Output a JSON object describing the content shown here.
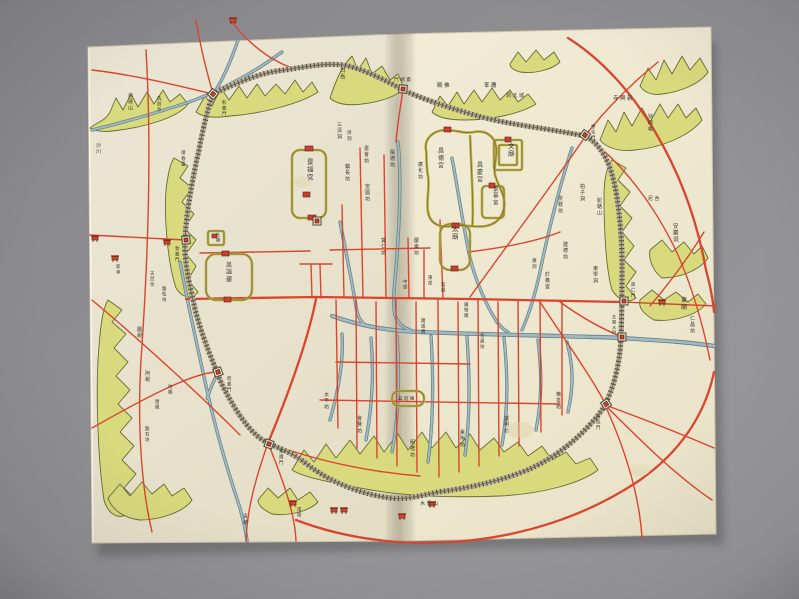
{
  "photo": {
    "description": "photograph of an opened book containing a hand-drawn historical map of Hanyang (Seoul)",
    "palette": {
      "backdrop_gray": "#8f8f92",
      "paper_cream": "#f1ecd7",
      "road_red": "#d8462f",
      "stream_blue": "#7f9ba6",
      "mountain_green": "#d9da7d",
      "wall_ink": "#544f3e",
      "palace_wall_olive": "#b9ad4a",
      "text_ink": "#37362c"
    }
  },
  "map": {
    "labels": [
      {
        "text": "景福宮",
        "x": 307,
        "y": 164,
        "dir": "v",
        "size": 6.5
      },
      {
        "text": "昌德宮",
        "x": 438,
        "y": 153,
        "dir": "v",
        "size": 6
      },
      {
        "text": "昌慶宮",
        "x": 477,
        "y": 167,
        "dir": "v",
        "size": 6
      },
      {
        "text": "景慕宮",
        "x": 493,
        "y": 191,
        "dir": "v",
        "size": 5.5
      },
      {
        "text": "文廟",
        "x": 508,
        "y": 148,
        "dir": "v",
        "size": 6.5
      },
      {
        "text": "太廟",
        "x": 452,
        "y": 231,
        "dir": "v",
        "size": 6.5
      },
      {
        "text": "慶熙宮",
        "x": 228,
        "y": 266,
        "dir": "vr",
        "size": 6
      },
      {
        "text": "社稷",
        "x": 216,
        "y": 236,
        "dir": "v",
        "size": 4.2
      },
      {
        "text": "三清洞",
        "x": 337,
        "y": 126,
        "dir": "v",
        "size": 5
      },
      {
        "text": "白岳",
        "x": 340,
        "y": 72,
        "dir": "v",
        "size": 5.5
      },
      {
        "text": "濟洞",
        "x": 347,
        "y": 134,
        "dir": "v",
        "size": 4.6
      },
      {
        "text": "嘉會坊",
        "x": 364,
        "y": 150,
        "dir": "v",
        "size": 5
      },
      {
        "text": "陽德坊",
        "x": 390,
        "y": 154,
        "dir": "v",
        "size": 5
      },
      {
        "text": "鎮長坊",
        "x": 345,
        "y": 168,
        "dir": "v",
        "size": 5
      },
      {
        "text": "安國坊",
        "x": 365,
        "y": 188,
        "dir": "v",
        "size": 5
      },
      {
        "text": "廣化坊",
        "x": 418,
        "y": 166,
        "dir": "v",
        "size": 5
      },
      {
        "text": "寬仁坊",
        "x": 381,
        "y": 242,
        "dir": "v",
        "size": 5
      },
      {
        "text": "慶幸坊",
        "x": 414,
        "y": 242,
        "dir": "v",
        "size": 5
      },
      {
        "text": "崇敎坊",
        "x": 558,
        "y": 200,
        "dir": "v",
        "size": 5
      },
      {
        "text": "柏子洞",
        "x": 580,
        "y": 188,
        "dir": "v",
        "size": 5
      },
      {
        "text": "建德坊",
        "x": 563,
        "y": 246,
        "dir": "v",
        "size": 5
      },
      {
        "text": "東學洞",
        "x": 593,
        "y": 270,
        "dir": "v",
        "size": 5
      },
      {
        "text": "於義宮",
        "x": 545,
        "y": 276,
        "dir": "v",
        "size": 5
      },
      {
        "text": "蓮洞",
        "x": 532,
        "y": 262,
        "dir": "v",
        "size": 4.6
      },
      {
        "text": "洞北城",
        "x": 506,
        "y": 97,
        "dir": "h",
        "size": 5
      },
      {
        "text": "峯鷹",
        "x": 484,
        "y": 87,
        "dir": "h",
        "size": 5.5
      },
      {
        "text": "殿佛",
        "x": 437,
        "y": 87,
        "dir": "h",
        "size": 5.5
      },
      {
        "text": "門靖肅",
        "x": 394,
        "y": 81,
        "dir": "h",
        "size": 4.6
      },
      {
        "text": "彰義門",
        "x": 222,
        "y": 104,
        "dir": "v",
        "size": 4.4
      },
      {
        "text": "惠化門",
        "x": 591,
        "y": 128,
        "dir": "v",
        "size": 4.4
      },
      {
        "text": "興仁門",
        "x": 631,
        "y": 286,
        "dir": "v",
        "size": 4.4
      },
      {
        "text": "五間水門",
        "x": 612,
        "y": 318,
        "dir": "v",
        "size": 4.2
      },
      {
        "text": "光熙門",
        "x": 596,
        "y": 418,
        "dir": "v",
        "size": 4.4
      },
      {
        "text": "崇禮門",
        "x": 279,
        "y": 453,
        "dir": "v",
        "size": 4.4
      },
      {
        "text": "昭義門",
        "x": 227,
        "y": 380,
        "dir": "v",
        "size": 4.4
      },
      {
        "text": "敦義門",
        "x": 175,
        "y": 250,
        "dir": "v",
        "size": 4.4
      },
      {
        "text": "東廟",
        "x": 681,
        "y": 302,
        "dir": "v",
        "size": 6
      },
      {
        "text": "仁昌坊",
        "x": 690,
        "y": 320,
        "dir": "v",
        "size": 5
      },
      {
        "text": "安巖洞",
        "x": 673,
        "y": 228,
        "dir": "v",
        "size": 5.5
      },
      {
        "text": "寺興新",
        "x": 613,
        "y": 100,
        "dir": "h",
        "size": 5.5
      },
      {
        "text": "狄踰峴",
        "x": 648,
        "y": 118,
        "dir": "v",
        "size": 5
      },
      {
        "text": "駝駱山",
        "x": 597,
        "y": 202,
        "dir": "v",
        "size": 5
      },
      {
        "text": "尼含",
        "x": 648,
        "y": 200,
        "dir": "h",
        "size": 5
      },
      {
        "text": "蕩春臺",
        "x": 181,
        "y": 154,
        "dir": "v",
        "size": 4.6
      },
      {
        "text": "洗劍亭",
        "x": 157,
        "y": 100,
        "dir": "v",
        "size": 4.4
      },
      {
        "text": "白蓮山",
        "x": 128,
        "y": 97,
        "dir": "v",
        "size": 5
      },
      {
        "text": "沙川",
        "x": 96,
        "y": 147,
        "dir": "v",
        "size": 5
      },
      {
        "text": "新寺",
        "x": 116,
        "y": 268,
        "dir": "v",
        "size": 4.4
      },
      {
        "text": "天然亭",
        "x": 150,
        "y": 275,
        "dir": "v",
        "size": 4.4
      },
      {
        "text": "盤松坊",
        "x": 162,
        "y": 290,
        "dir": "v",
        "size": 4.4
      },
      {
        "text": "圜峴",
        "x": 137,
        "y": 331,
        "dir": "v",
        "size": 5
      },
      {
        "text": "阿峴",
        "x": 145,
        "y": 375,
        "dir": "v",
        "size": 5
      },
      {
        "text": "坑橋",
        "x": 168,
        "y": 388,
        "dir": "v",
        "size": 4.4
      },
      {
        "text": "唐峴",
        "x": 155,
        "y": 403,
        "dir": "v",
        "size": 4.4
      },
      {
        "text": "盤石坊",
        "x": 145,
        "y": 430,
        "dir": "v",
        "size": 4.4
      },
      {
        "text": "青坡",
        "x": 243,
        "y": 518,
        "dir": "v",
        "size": 5
      },
      {
        "text": "南壇",
        "x": 297,
        "y": 511,
        "dir": "v",
        "size": 4.4
      },
      {
        "text": "木覓山",
        "x": 420,
        "y": 505,
        "dir": "h",
        "size": 5
      },
      {
        "text": "中部",
        "x": 403,
        "y": 283,
        "dir": "v",
        "size": 4.4
      },
      {
        "text": "東部",
        "x": 428,
        "y": 279,
        "dir": "v",
        "size": 4.4
      },
      {
        "text": "梨峴",
        "x": 441,
        "y": 286,
        "dir": "v",
        "size": 4.4
      },
      {
        "text": "鐵物橋",
        "x": 464,
        "y": 306,
        "dir": "v",
        "size": 4.4
      },
      {
        "text": "廣通橋",
        "x": 421,
        "y": 322,
        "dir": "v",
        "size": 4.4
      },
      {
        "text": "長通坊",
        "x": 480,
        "y": 337,
        "dir": "v",
        "size": 4.4
      },
      {
        "text": "太平坊",
        "x": 324,
        "y": 396,
        "dir": "v",
        "size": 5
      },
      {
        "text": "會賢坊",
        "x": 357,
        "y": 420,
        "dir": "v",
        "size": 5
      },
      {
        "text": "明禮坊",
        "x": 410,
        "y": 444,
        "dir": "v",
        "size": 5
      },
      {
        "text": "薰陶坊",
        "x": 460,
        "y": 434,
        "dir": "v",
        "size": 5
      },
      {
        "text": "誠明坊",
        "x": 504,
        "y": 420,
        "dir": "v",
        "size": 5
      },
      {
        "text": "樂善坊",
        "x": 556,
        "y": 396,
        "dir": "v",
        "size": 5
      },
      {
        "text": "南別宮",
        "x": 398,
        "y": 401,
        "dir": "hr",
        "size": 4.6
      }
    ],
    "gates": [
      {
        "name": "changuimun-gate",
        "x": 213,
        "y": 94,
        "a": -50
      },
      {
        "name": "sukjeongmun-gate",
        "x": 403,
        "y": 89,
        "a": 5
      },
      {
        "name": "hyehwamun-gate",
        "x": 585,
        "y": 135,
        "a": 35
      },
      {
        "name": "heunginmun-gate",
        "x": 624,
        "y": 301,
        "a": 90
      },
      {
        "name": "ogansumun-gate",
        "x": 622,
        "y": 337,
        "a": 90
      },
      {
        "name": "gwanghuimun-gate",
        "x": 606,
        "y": 404,
        "a": 55
      },
      {
        "name": "sungnyemun-gate",
        "x": 269,
        "y": 444,
        "a": 20
      },
      {
        "name": "souimun-gate",
        "x": 218,
        "y": 372,
        "a": 70
      },
      {
        "name": "donuimun-gate",
        "x": 186,
        "y": 240,
        "a": 85
      },
      {
        "name": "gwanghwamun-gate",
        "x": 317,
        "y": 221,
        "a": 0
      }
    ],
    "buildings": [
      [
        95,
        238
      ],
      [
        115,
        258
      ],
      [
        167,
        242
      ],
      [
        233,
        20
      ],
      [
        293,
        503
      ],
      [
        334,
        510
      ],
      [
        344,
        510
      ],
      [
        402,
        516
      ],
      [
        432,
        504
      ],
      [
        662,
        302
      ]
    ]
  }
}
